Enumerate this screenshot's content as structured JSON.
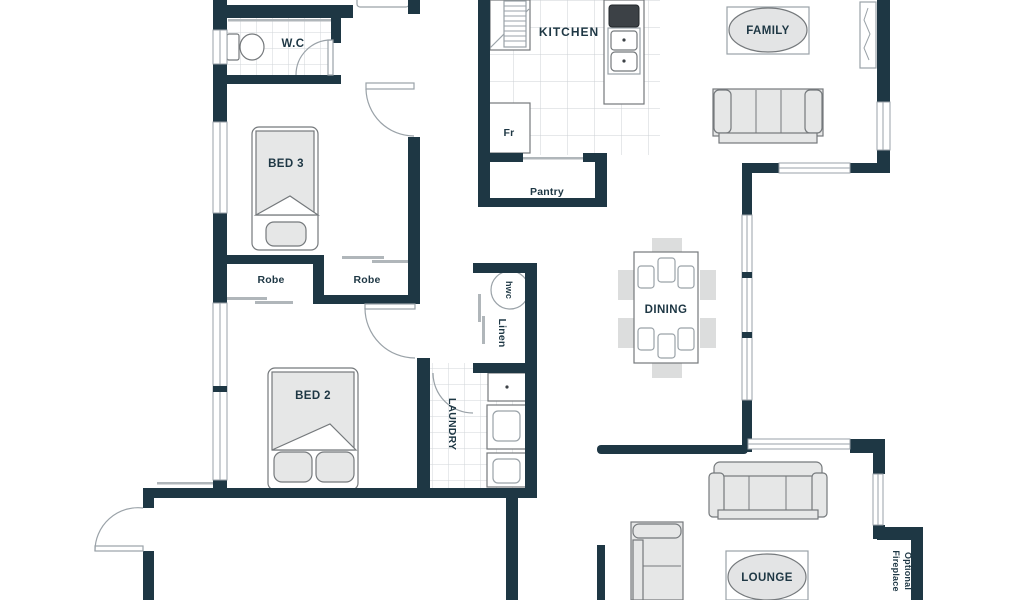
{
  "plan": {
    "colors": {
      "wall": "#1e3744",
      "text": "#1e3744",
      "furniture_fill": "#e6e7e7",
      "furniture_stroke": "#75797c",
      "tile_line": "#d2d6d8",
      "window_line": "#9aa2a8"
    },
    "rooms": {
      "wc": "W.C",
      "bed3": "BED 3",
      "robe_left": "Robe",
      "robe_right": "Robe",
      "bed2": "BED 2",
      "laundry": "LAUNDRY",
      "kitchen": "KITCHEN",
      "pantry": "Pantry",
      "dining": "DINING",
      "family": "FAMILY",
      "lounge": "LOUNGE"
    },
    "fixtures": {
      "fridge": "Fr",
      "hot_water_cylinder": "hwc",
      "linen": "Linen"
    },
    "notes": {
      "fireplace_line1": "Fireplace",
      "fireplace_line2": "Optional"
    }
  }
}
